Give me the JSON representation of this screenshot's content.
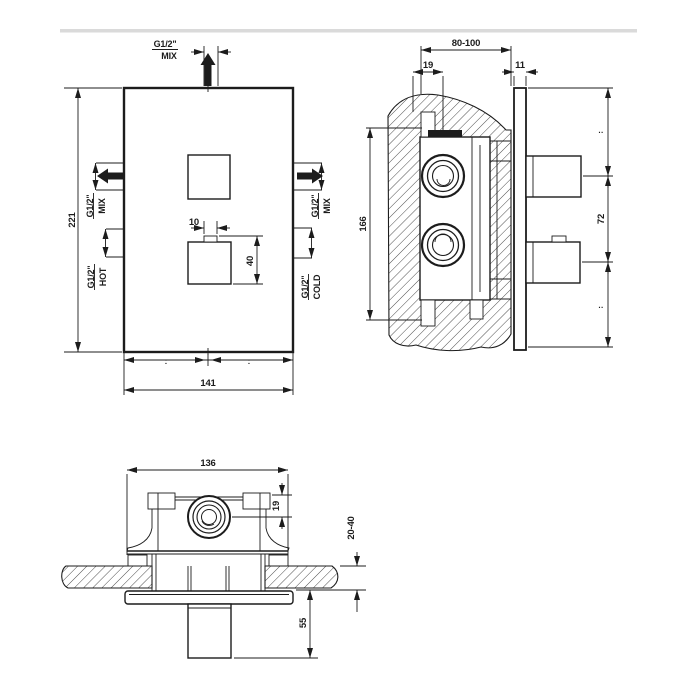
{
  "colors": {
    "line": "#1c1c1c",
    "background": "#ffffff",
    "hatch": "#3a3a3a",
    "top_divider": "#dadada"
  },
  "views": {
    "front": {
      "ports": {
        "top": {
          "thread": "G1/2\"",
          "label": "MIX"
        },
        "left_mix": {
          "thread": "G1/2\"",
          "label": "MIX"
        },
        "left_hot": {
          "thread": "G1/2\"",
          "label": "HOT"
        },
        "right_mix": {
          "thread": "G1/2\"",
          "label": "MIX"
        },
        "right_cold": {
          "thread": "G1/2\"",
          "label": "COLD"
        }
      },
      "dims": {
        "height": "221",
        "width": "141",
        "stem_width": "10",
        "handle_height": "40",
        "sub_left": ":",
        "sub_right": ":"
      }
    },
    "section": {
      "dims": {
        "depth_range": "80-100",
        "inlet_offset": "19",
        "plate_thickness": "11",
        "body_height": "166",
        "handle_pitch": "72",
        "upper_mark": "··",
        "lower_mark": "··"
      }
    },
    "bottom": {
      "dims": {
        "width": "136",
        "port_depth": "19",
        "wall_thickness_range": "20-40",
        "handle_protrusion": "55"
      }
    }
  }
}
